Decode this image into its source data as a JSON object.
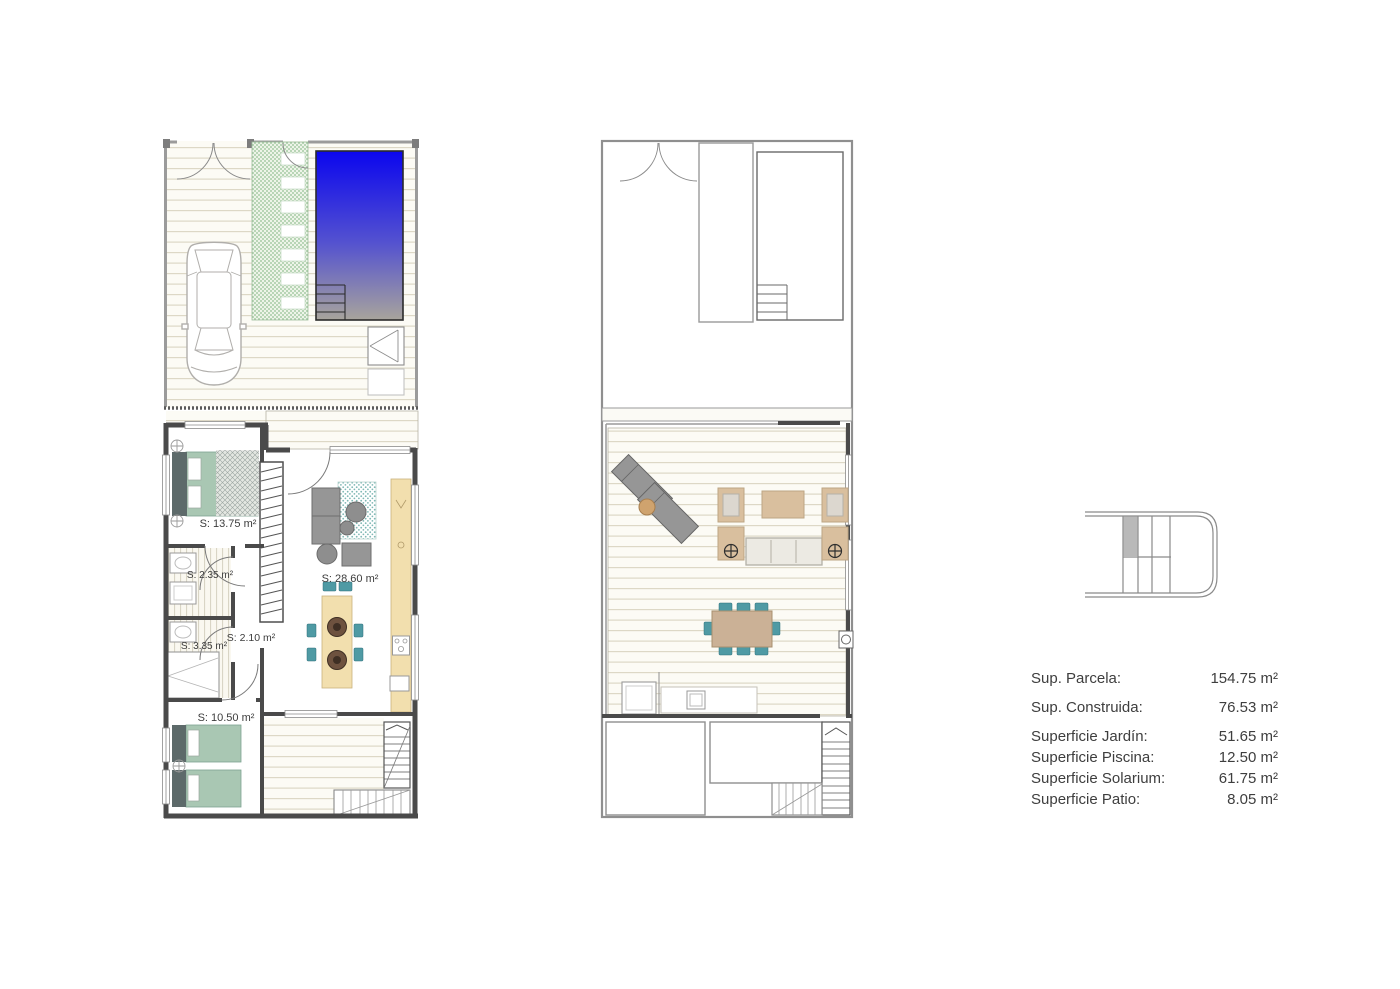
{
  "plans": {
    "ground": {
      "rooms": {
        "bedroom_main": "S: 13.75 m²",
        "bath_1": "S: 2.35 m²",
        "hall": "S: 2.10 m²",
        "bath_2": "S: 3.35 m²",
        "living_kitchen": "S: 28.60 m²",
        "bedroom_2": "S: 10.50 m²"
      }
    }
  },
  "summary": {
    "rows": [
      {
        "label": "Sup. Parcela:",
        "value": "154.75 m²"
      },
      {
        "label": "Sup. Construida:",
        "value": "76.53 m²"
      },
      {
        "label": "Superficie Jardín:",
        "value": "51.65 m²"
      },
      {
        "label": "Superficie Piscina:",
        "value": "12.50 m²"
      },
      {
        "label": "Superficie Solarium:",
        "value": "61.75 m²"
      },
      {
        "label": "Superficie Patio:",
        "value": "8.05 m²"
      }
    ]
  },
  "colors": {
    "pool_top": "#0b06ee",
    "pool_mid": "#5553cf",
    "pool_bottom": "#a8a49c",
    "bed_green": "#a9c7b3",
    "chair_teal": "#4f9aa4",
    "counter_cream": "#f2dfae",
    "table_tan": "#cbb196",
    "armchair_tan": "#d9bf9e",
    "sofa_gray": "#969696",
    "wall_dark": "#4a4a4a",
    "wall_light": "#9b9b9b",
    "garden_green": "#92bf92",
    "highlight_gray": "#b9b9b9"
  }
}
